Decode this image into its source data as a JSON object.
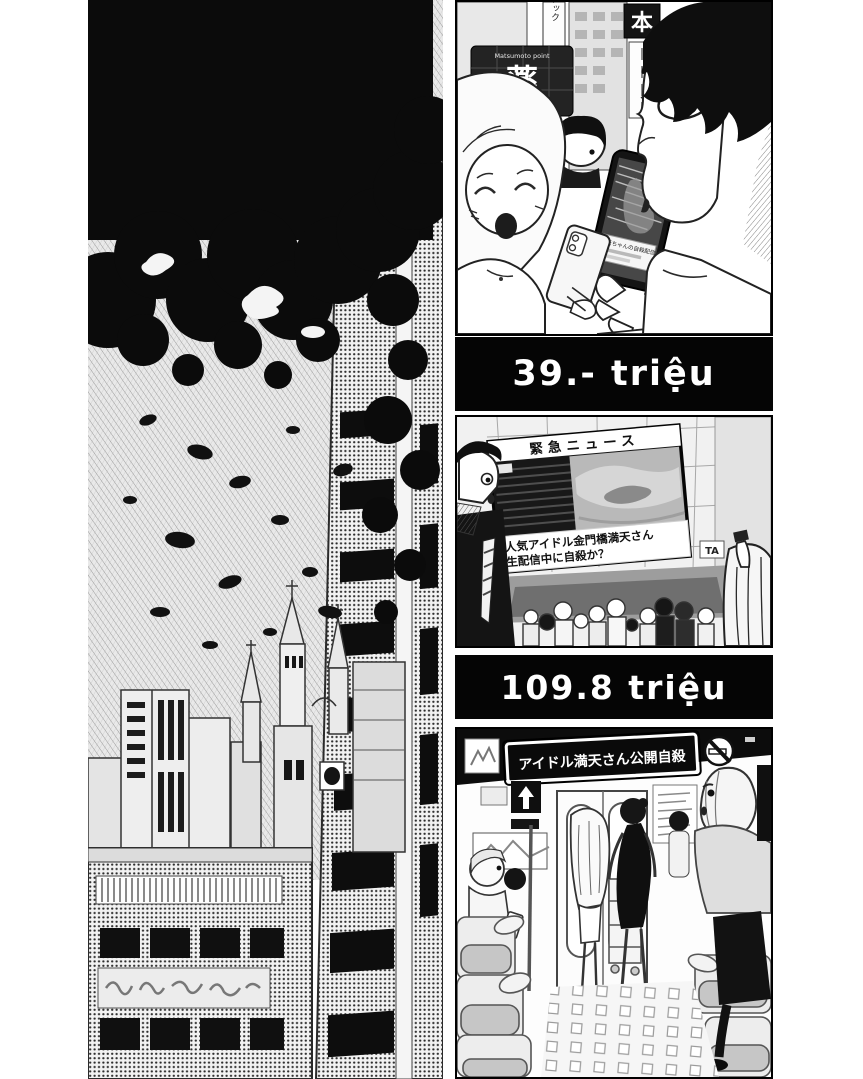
{
  "page": {
    "type": "manga-page",
    "background": "#ffffff",
    "ink_color": "#0b0b0b",
    "tone_gray": "#c9c9c9"
  },
  "captions": {
    "view_count_1": "39.- triệu",
    "view_count_2": "109.8 triệu"
  },
  "panel_street": {
    "pharmacy_sign_top": "Matsumoto point",
    "pharmacy_sign_kanji": "薬",
    "pharmacy_sign_katakana": "ト サトシ",
    "vertical_banner": "アック",
    "book_sign": "本",
    "phone_stream_caption": "満天ちゃんの自殺配信"
  },
  "panel_news": {
    "screen_header": "緊急ニュース",
    "screen_caption_line1": "人気アイドル金門橋満天さん",
    "screen_caption_line2": "生配信中に自殺か？",
    "building_sign": "TA"
  },
  "panel_train": {
    "ticker_sign": "アイドル満天さん公開自殺"
  }
}
